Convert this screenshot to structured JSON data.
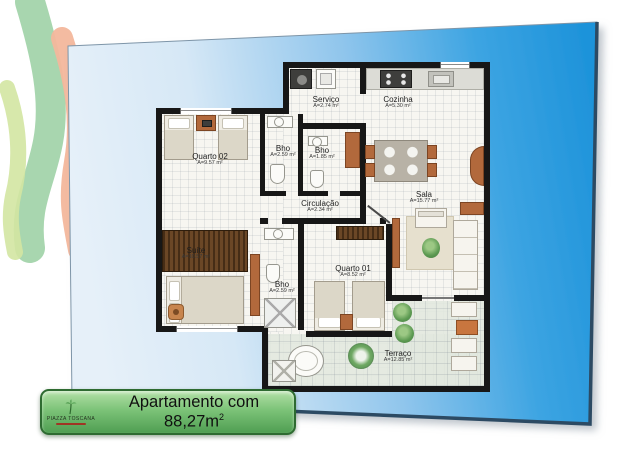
{
  "banner": {
    "title": "Apartamento com 88,27m",
    "title_sup": "2",
    "logo_name": "Piazza Toscana"
  },
  "plan": {
    "rooms": {
      "quarto02": {
        "name": "Quarto 02",
        "area": "A=9.57 m²"
      },
      "bho_social": {
        "name": "Bho",
        "area": "A=2.59 m²"
      },
      "bho_pequeno": {
        "name": "Bho",
        "area": "A=1.85 m²"
      },
      "servico": {
        "name": "Serviço",
        "area": "A=2.74 m²"
      },
      "cozinha": {
        "name": "Cozinha",
        "area": "A=5.30 m²"
      },
      "circulacao": {
        "name": "Circulação",
        "area": "A=2.34 m²"
      },
      "sala": {
        "name": "Sala",
        "area": "A=15.77 m²"
      },
      "suite": {
        "name": "Suíte",
        "area": "A=10.57 m²"
      },
      "bho_suite": {
        "name": "Bho",
        "area": "A=2.59 m²"
      },
      "quarto01": {
        "name": "Quarto 01",
        "area": "A=8.52 m²"
      },
      "terraco": {
        "name": "Terraço",
        "area": "A=12.85 m²"
      }
    }
  },
  "colors": {
    "panel_blue_deep": "#1e93da",
    "panel_blue_light": "#e6f0f9",
    "banner_green": "#63b05e",
    "wall_black": "#171717",
    "wood": "#b2693c",
    "ribbon_green": "#9ed2a6",
    "ribbon_yellow_green": "#d3e6a2",
    "ribbon_salmon": "#f3b79c"
  }
}
